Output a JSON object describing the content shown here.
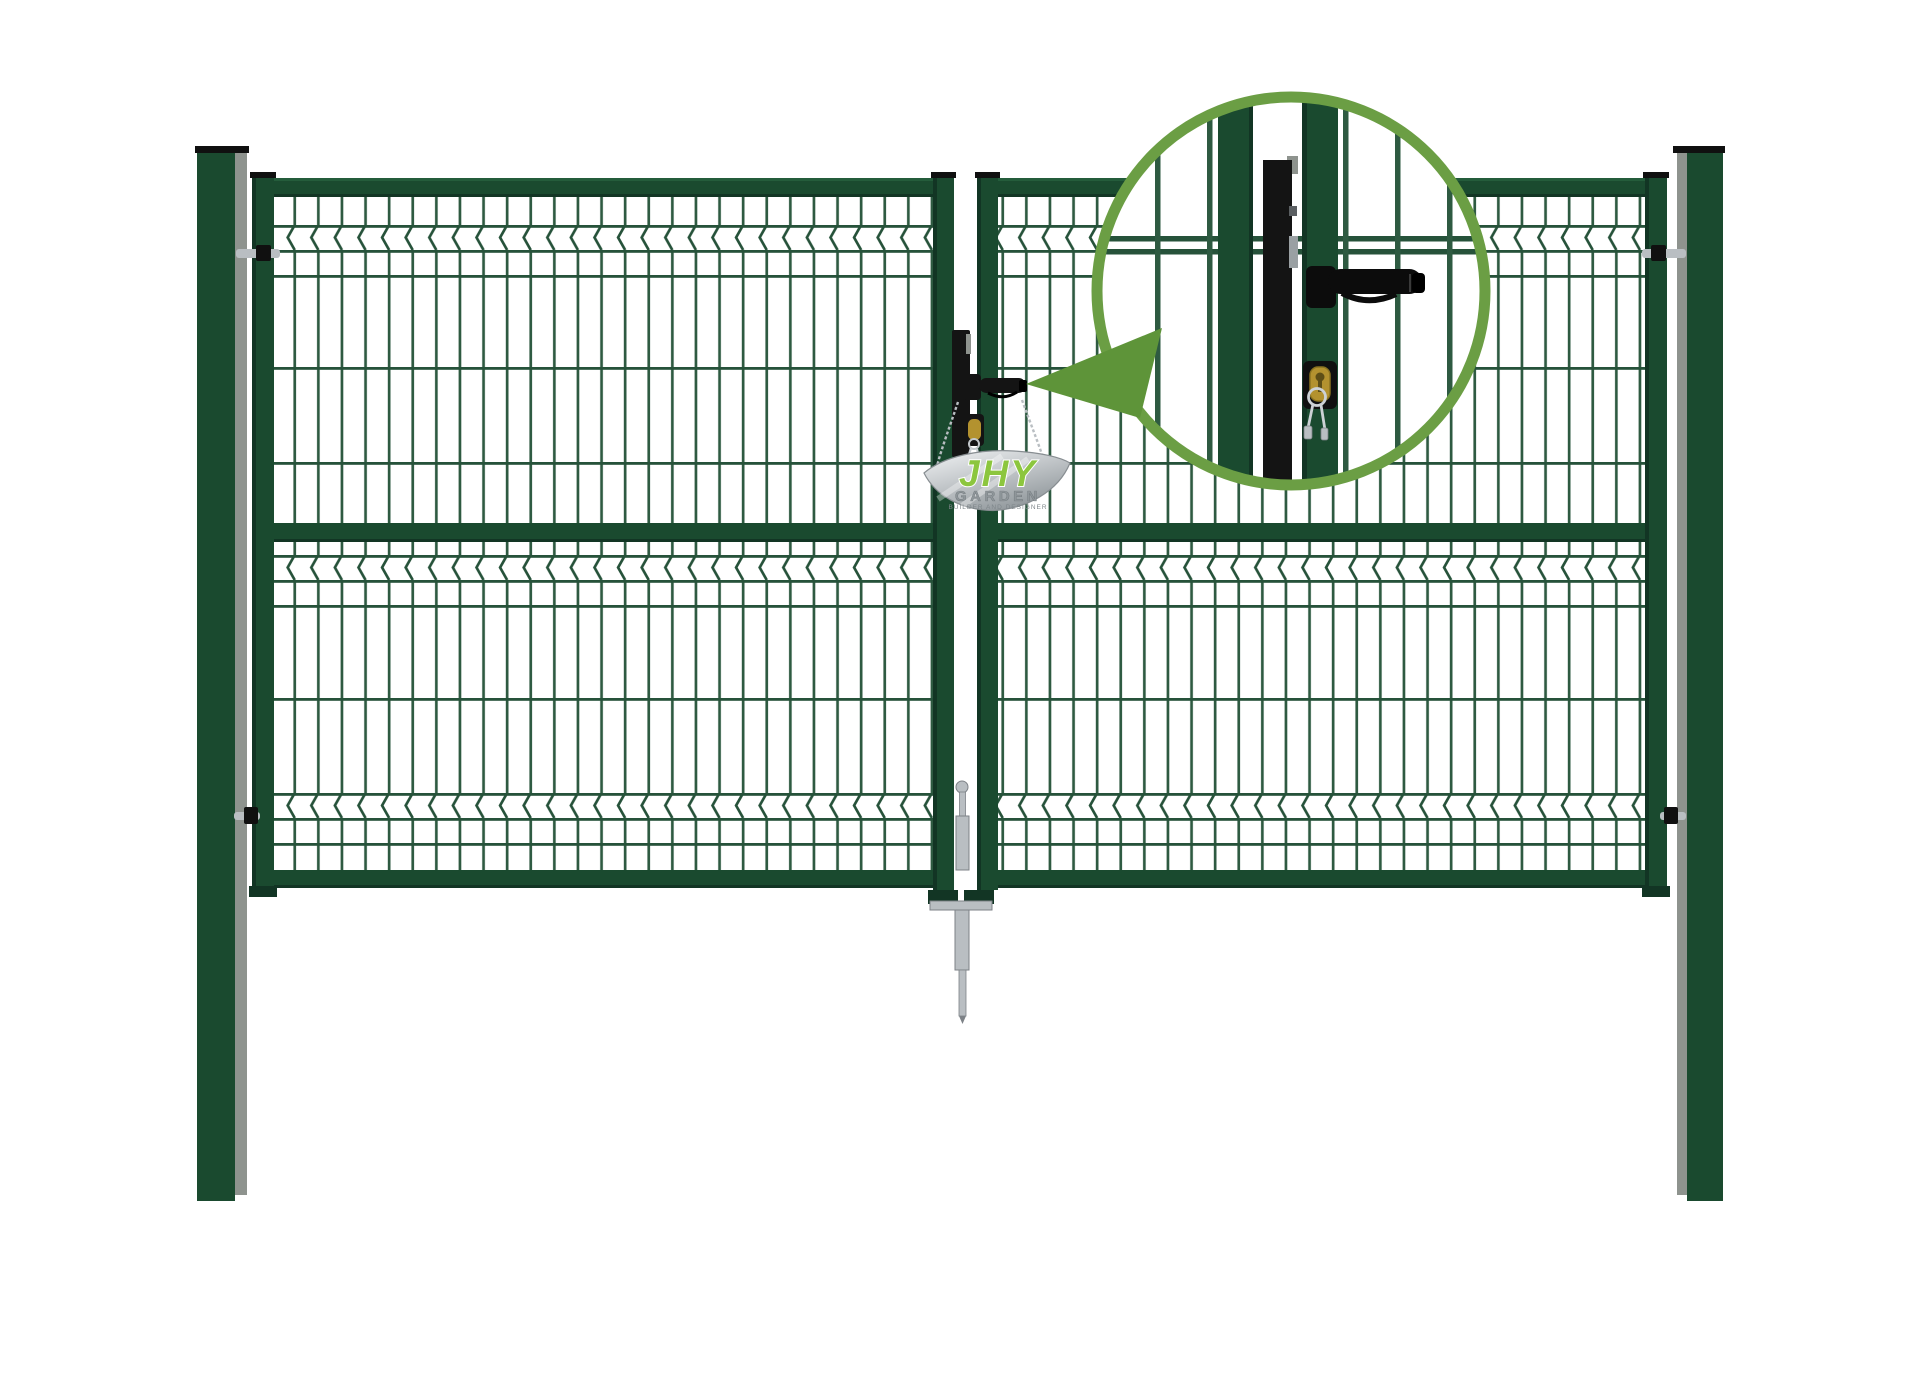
{
  "scene": {
    "type": "product-render",
    "background": "#ffffff",
    "description": "Dark-green double-leaf garden gate with welded mesh infill panels, two square posts, central lever-handle lock with key cylinder, ground drop bolt, and a magnifier circle calling out the lock detail"
  },
  "logo": {
    "brand": "JHY",
    "word": "GARDEN",
    "tagline": "BUILDER AND DESIGNER"
  },
  "callout": {
    "shape": "circle",
    "content": "magnified gate lock with lever handle, latch and brass key cylinder with keys"
  },
  "colors": {
    "frame_green": "#1a4a2f",
    "frame_light": "#245c3b",
    "frame_dark": "#123524",
    "cap_black": "#101010",
    "wire_green": "#2e5a41",
    "wire_dark": "#26523a",
    "post_grey": "#8e938e",
    "steel": "#b9bec2",
    "steel_dark": "#7d8287",
    "lock_black": "#141414",
    "callout_ring": "#6b9e44",
    "pointer": "#5e9439",
    "logo_green": "#8cc63e",
    "plate_silver_light": "#eff1f2",
    "plate_silver_dark": "#9aa0a4",
    "brass": "#b3922f"
  }
}
